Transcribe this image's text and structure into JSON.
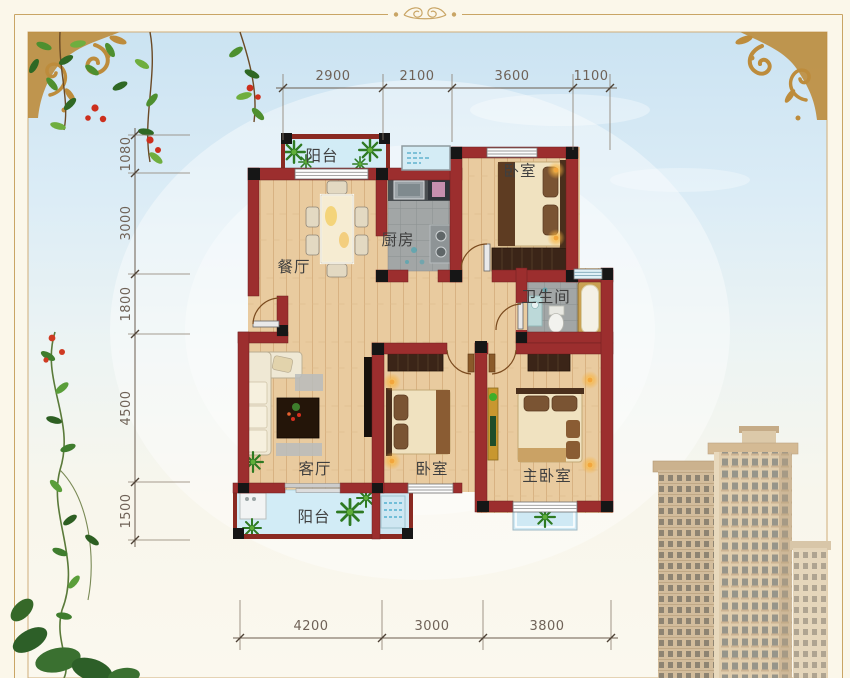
{
  "image_type": "apartment-floor-plan",
  "rooms": {
    "balcony_top": "阳台",
    "kitchen": "厨房",
    "bedroom_top": "卧室",
    "dining": "餐厅",
    "bathroom": "卫生间",
    "living": "客厅",
    "bedroom_mid": "卧室",
    "master": "主卧室",
    "balcony_bottom": "阳台"
  },
  "dimensions": {
    "top": [
      "2900",
      "2100",
      "3600",
      "1100"
    ],
    "left": [
      "1080",
      "3000",
      "1800",
      "4500",
      "1500"
    ],
    "bottom": [
      "4200",
      "3000",
      "3800"
    ]
  },
  "colors": {
    "wall": "#9c2e2e",
    "wood_floor": "#e9cb9f",
    "tile_floor": "#a2a6a6",
    "balcony_floor": "#d2ecf6",
    "frame_gold": "#c9a565",
    "sky": "#cbe3f2",
    "page_background": "#fbf7ea"
  }
}
